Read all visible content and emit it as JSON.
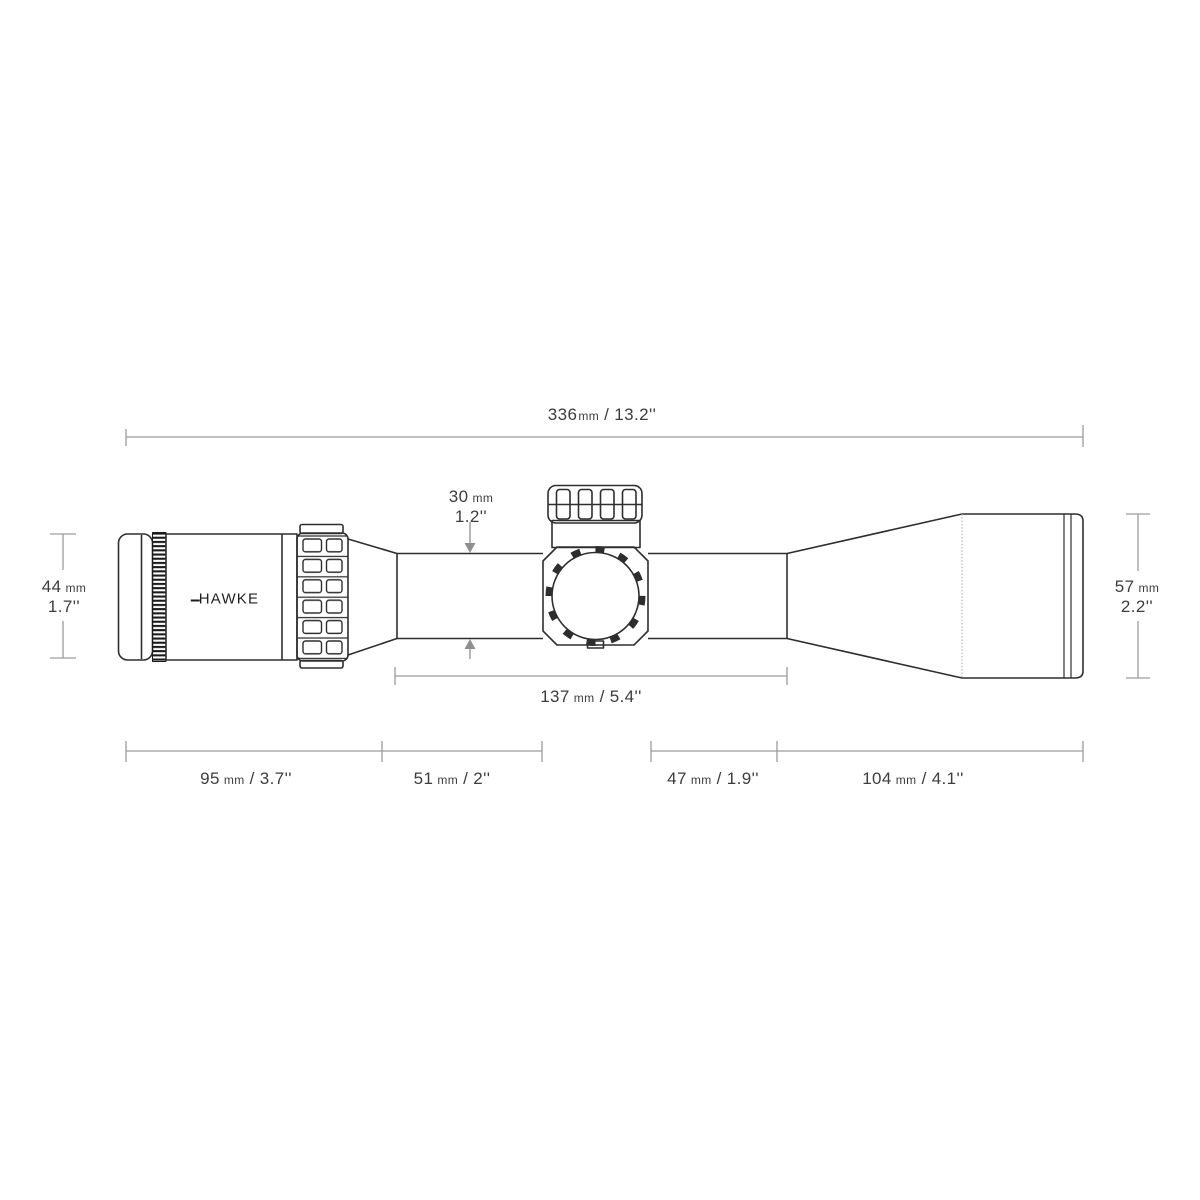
{
  "brand": {
    "logo_text": "HAWKE"
  },
  "colors": {
    "background": "#ffffff",
    "scope_outline": "#2e2e2e",
    "knurl_dark": "#1b1b1b",
    "dimension_line": "#9c9c9c",
    "arrow": "#8f8f8f",
    "label_text": "#3d3d3d"
  },
  "dimensions": {
    "overall_length": {
      "mm": "336",
      "unit": "mm",
      "sep": "/",
      "inches": "13.2''"
    },
    "tube_diameter": {
      "mm": "30",
      "unit": "mm",
      "inches": "1.2''"
    },
    "eyepiece_diameter": {
      "mm": "44",
      "unit": "mm",
      "inches": "1.7''"
    },
    "objective_diameter": {
      "mm": "57",
      "unit": "mm",
      "inches": "2.2''"
    },
    "mount_span": {
      "mm": "137",
      "unit": "mm",
      "sep": "/",
      "inches": "5.4''"
    },
    "segment_eyepiece": {
      "mm": "95",
      "unit": "mm",
      "sep": "/",
      "inches": "3.7''"
    },
    "segment_tube_left": {
      "mm": "51",
      "unit": "mm",
      "sep": "/",
      "inches": "2''"
    },
    "segment_tube_right": {
      "mm": "47",
      "unit": "mm",
      "sep": "/",
      "inches": "1.9''"
    },
    "segment_objective": {
      "mm": "104",
      "unit": "mm",
      "sep": "/",
      "inches": "4.1''"
    }
  }
}
